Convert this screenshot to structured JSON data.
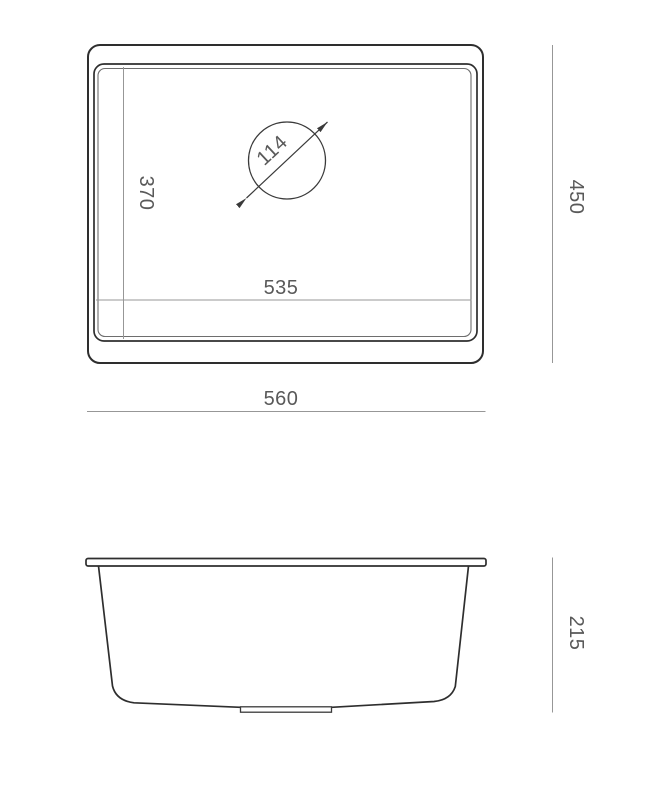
{
  "colors": {
    "background": "#ffffff",
    "outline_dark": "#2e2e2e",
    "outline_mid": "#3a3a3a",
    "outline_light": "#6e6e6e",
    "dimension_line": "#979797",
    "dimension_text": "#595959"
  },
  "top_view": {
    "overall_width": "560",
    "overall_height": "450",
    "inner_width": "535",
    "inner_depth": "370",
    "drain_diameter": "114"
  },
  "side_view": {
    "height": "215"
  }
}
